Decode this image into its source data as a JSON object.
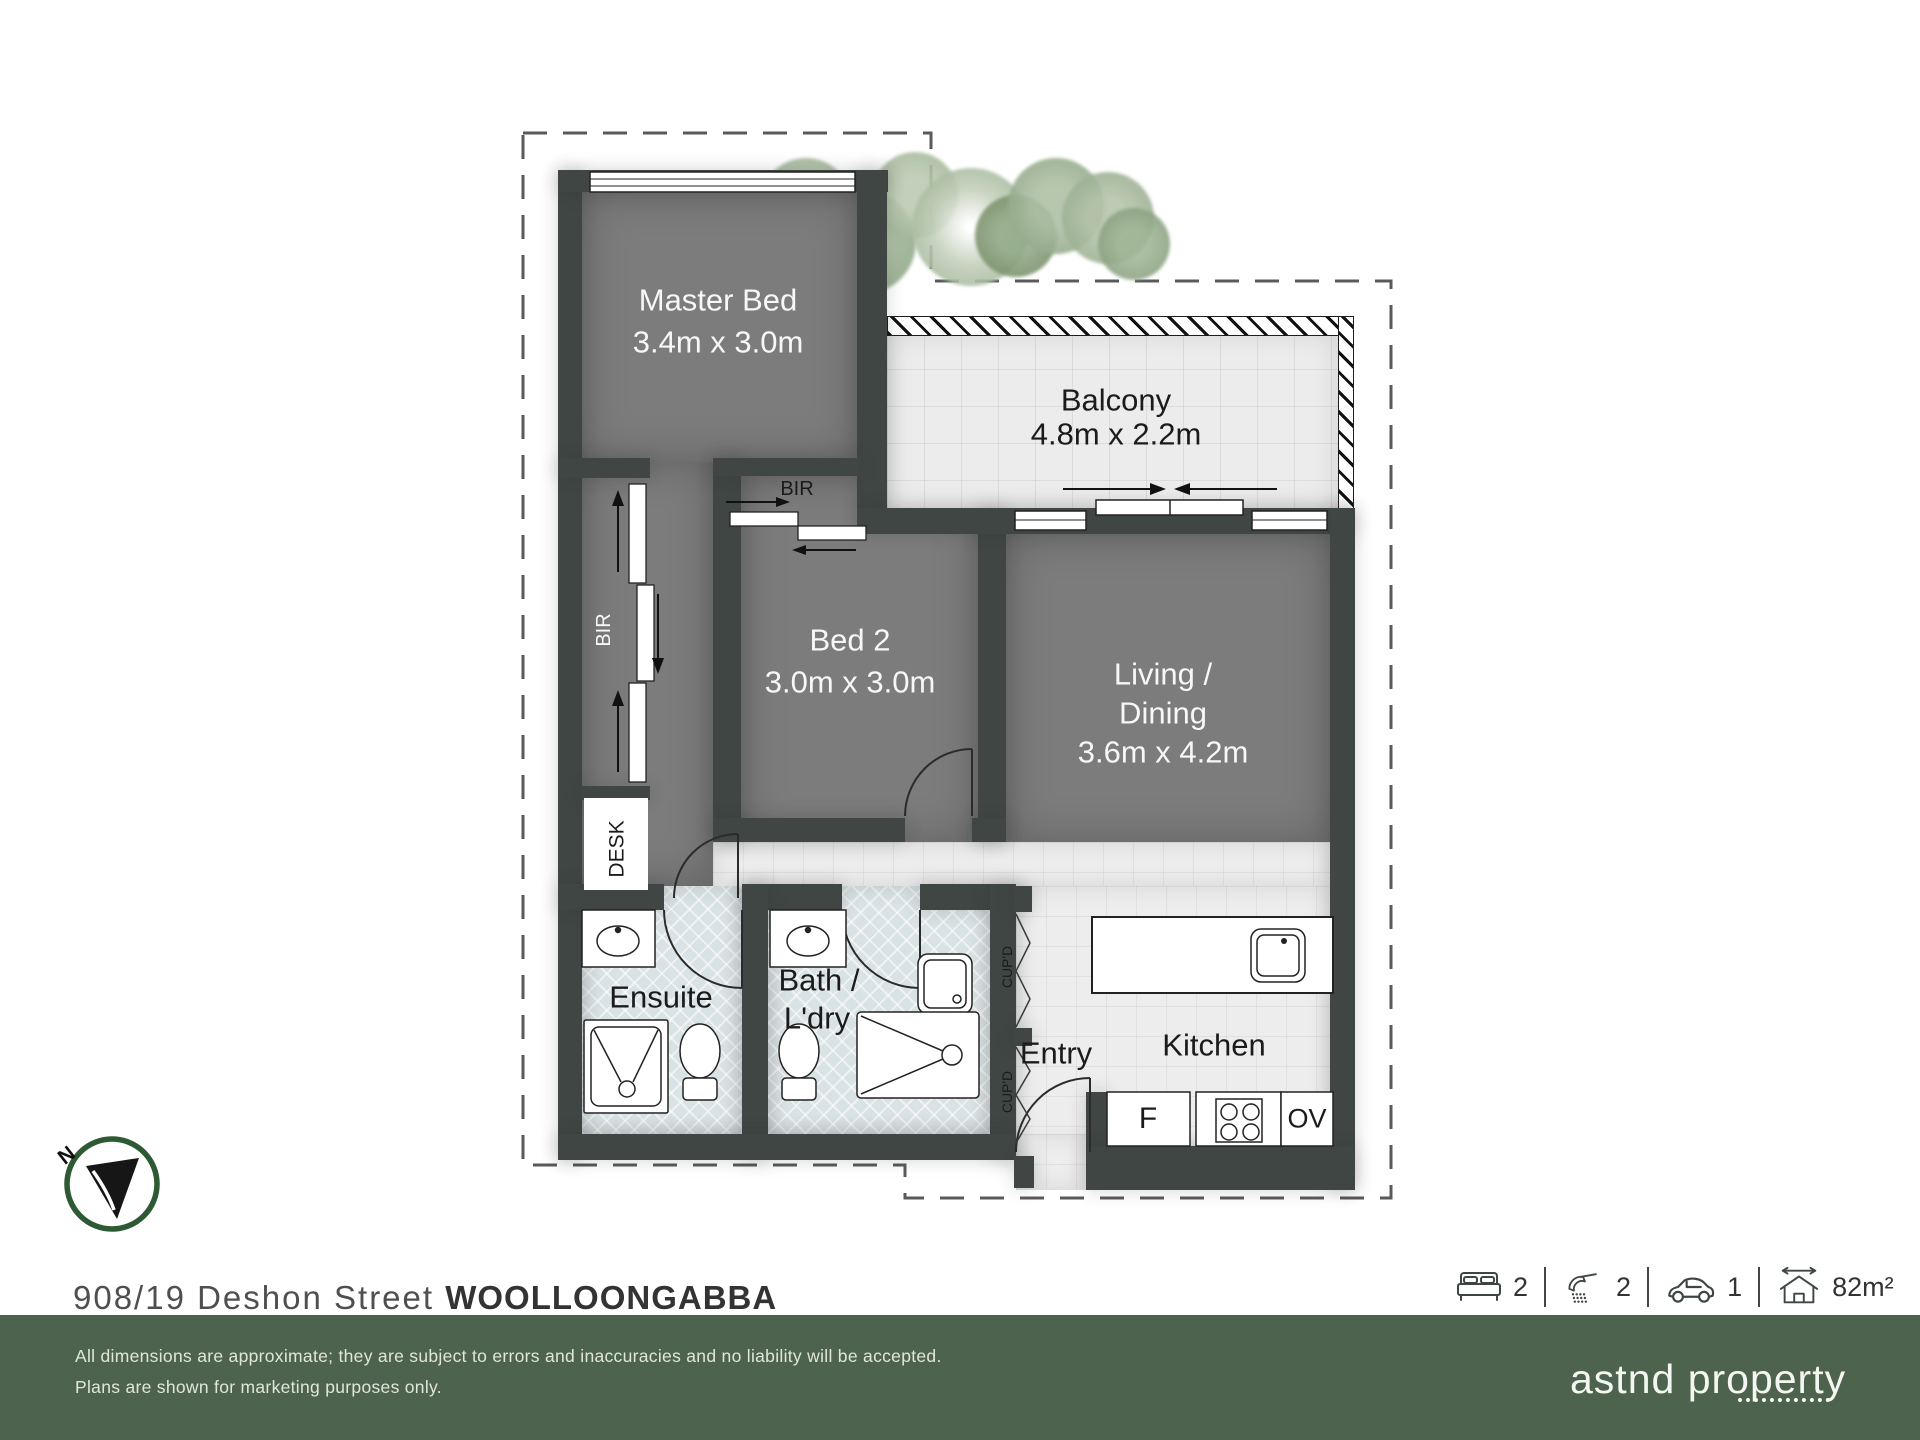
{
  "colors": {
    "wall": "#3f4644",
    "floor_dark": "#7c7c7c",
    "floor_light": "#ededed",
    "floor_bath": "#d9e2e4",
    "footer_green": "#4e634e",
    "compass_green": "#2d5a32"
  },
  "plan": {
    "rooms": {
      "master": {
        "name": "Master Bed",
        "dims": "3.4m x 3.0m"
      },
      "balcony": {
        "name": "Balcony",
        "dims": "4.8m x 2.2m"
      },
      "bed2": {
        "name": "Bed 2",
        "dims": "3.0m x 3.0m"
      },
      "living": {
        "line1": "Living /",
        "line2": "Dining",
        "dims": "3.6m x 4.2m"
      },
      "ensuite": {
        "name": "Ensuite"
      },
      "bath": {
        "line1": "Bath /",
        "line2": "L'dry"
      },
      "entry": {
        "name": "Entry"
      },
      "kitchen": {
        "name": "Kitchen"
      }
    },
    "fixtures": {
      "bir": "BIR",
      "desk": "DESK",
      "cupd": "CUP'D",
      "fridge": "F",
      "oven": "OV"
    },
    "compass": {
      "north": "N"
    }
  },
  "address": {
    "street": "908/19 Deshon Street",
    "suburb": "WOOLLOONGABBA"
  },
  "stats": {
    "beds": {
      "icon": "bed-icon",
      "value": "2"
    },
    "baths": {
      "icon": "shower-icon",
      "value": "2"
    },
    "cars": {
      "icon": "car-icon",
      "value": "1"
    },
    "area": {
      "icon": "area-icon",
      "value": "82m²"
    }
  },
  "footer": {
    "disclaimer_line1": "All dimensions are approximate; they are subject to errors and inaccuracies and no liability will be accepted.",
    "disclaimer_line2": "Plans are shown for marketing purposes only.",
    "brand": "astnd property"
  }
}
